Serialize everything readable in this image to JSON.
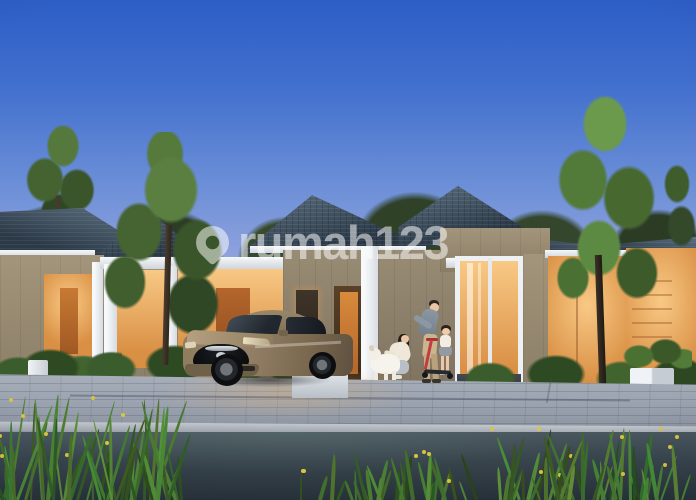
{
  "watermark": {
    "text": "rumah123",
    "icon": "location-pin-icon"
  },
  "scene": {
    "type": "real-estate dusk rendering",
    "objects": [
      "sky",
      "background-trees",
      "row-houses with warm lit interiors",
      "carport",
      "bronze sedan",
      "family: man, girl on red scooter, crouching woman, white dog",
      "paver driveway",
      "road",
      "ornamental grass with yellow flowers",
      "white planters",
      "lawn"
    ]
  },
  "palette": {
    "sky-top": "#2d5ec6",
    "sky-upper": "#3f6ecd",
    "sky-mid": "#6e90d8",
    "sky-low": "#a8b0e0",
    "sky-horizon": "#ddd3e2",
    "roof-dark": "#2c3a48",
    "roof-light": "#5f7384",
    "wall-taupe": "#a3957b",
    "wall-dark": "#8a7d66",
    "glow-bright": "#f8c985",
    "glow-deep": "#d98f44",
    "door-orange": "#b4662c",
    "tree-dark": "#2f4126",
    "tree-mid": "#49682f",
    "tree-light": "#699647",
    "paver": "#9ba3b0",
    "curb": "#c2c6cd",
    "road-top": "#4a575f",
    "road-deep": "#273138",
    "car-bronze": "#96826a",
    "car-bronze-dark": "#5e5140",
    "scooter-red": "#c23c40",
    "flower-yellow": "#d9c53e",
    "watermark": "rgba(255,255,255,0.52)"
  }
}
